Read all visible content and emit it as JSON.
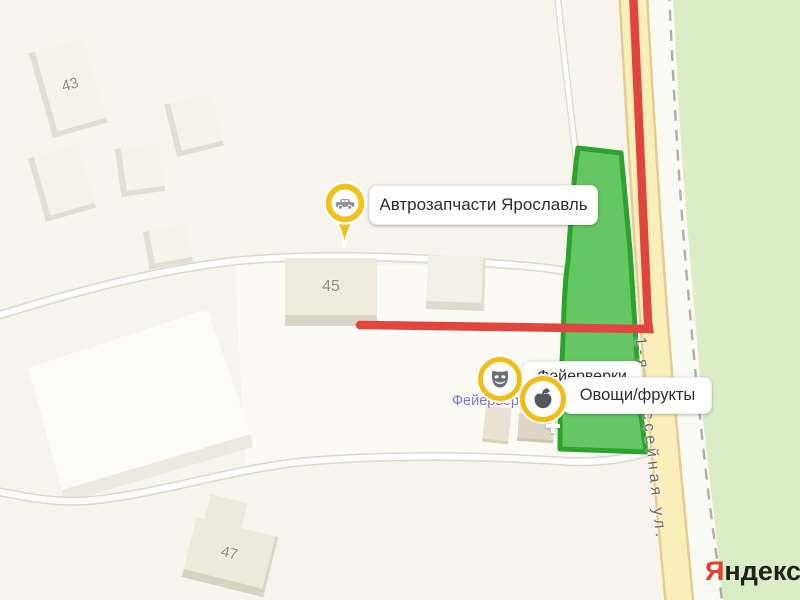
{
  "map": {
    "street_label": "1-я Шоссейная ул.",
    "buildings": [
      {
        "number": "43"
      },
      {
        "number": "45"
      },
      {
        "number": "47"
      }
    ],
    "pois": [
      {
        "id": "auto-parts",
        "label": "Автрозапчасти Ярославль",
        "icon": "car-pin"
      },
      {
        "id": "fireworks",
        "label": "Фейерверки",
        "icon": "theater-mask"
      },
      {
        "id": "produce",
        "label": "Овощи/фрукты",
        "icon": "apple"
      }
    ],
    "shop_map_label": "Фейерверки",
    "logo": {
      "ya": "Я",
      "rest": "ндекс"
    },
    "colors": {
      "background": "#f6f4ed",
      "forest": "#dbedc5",
      "parcel_fill": "#64c763",
      "parcel_border": "#2da32d",
      "route": "#e1463e",
      "road_fill": "#f8efbb",
      "road_casing": "#e8cb90",
      "minor_road_fill": "#ffffff",
      "minor_road_casing": "#dcd8cd",
      "badge_ring": "#f2bd17",
      "pin_fill": "#f3c11c",
      "logo_red": "#e0402e"
    }
  }
}
